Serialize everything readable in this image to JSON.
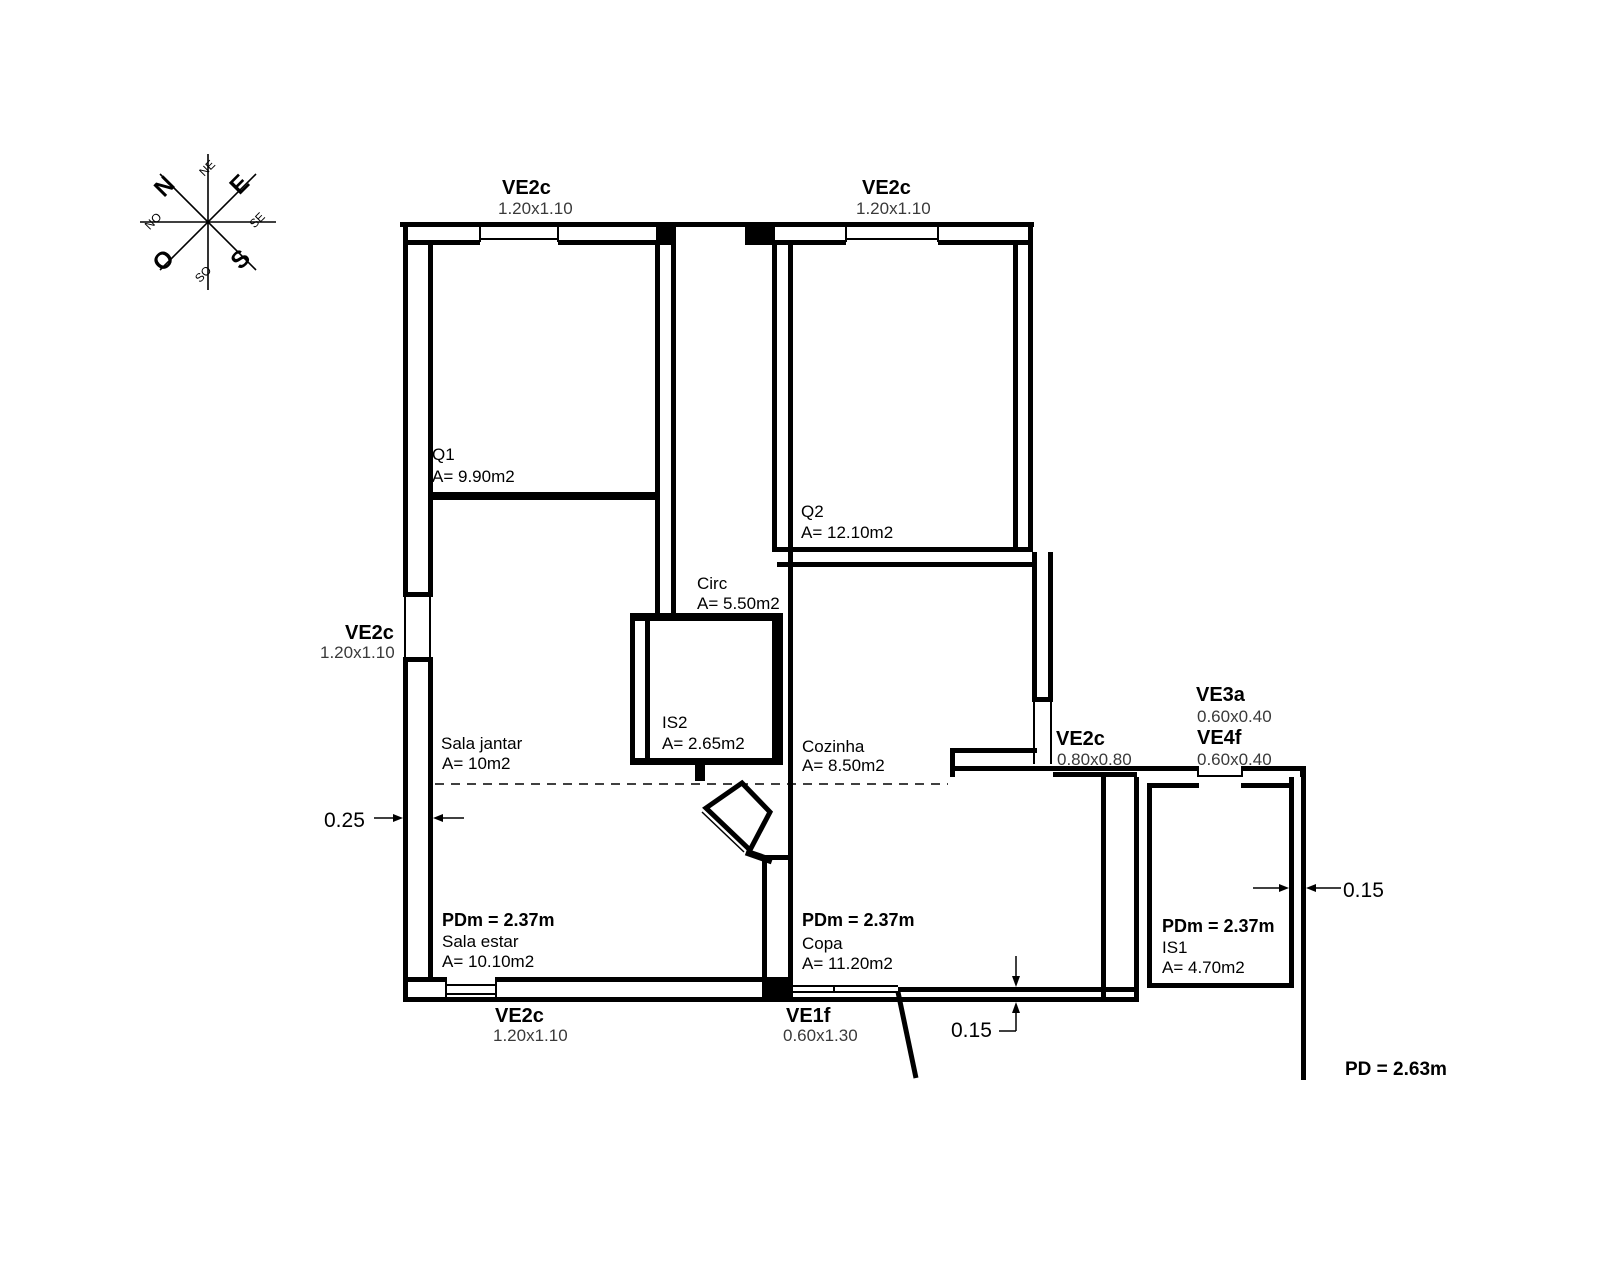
{
  "compass": {
    "n": "N",
    "e": "E",
    "s": "S",
    "o": "O",
    "ne": "NE",
    "se": "SE",
    "so": "SO",
    "no": "NO"
  },
  "openings": {
    "ve2c_top_left": {
      "code": "VE2c",
      "size": "1.20x1.10"
    },
    "ve2c_top_right": {
      "code": "VE2c",
      "size": "1.20x1.10"
    },
    "ve2c_left": {
      "code": "VE2c",
      "size": "1.20x1.10"
    },
    "ve2c_bottom": {
      "code": "VE2c",
      "size": "1.20x1.10"
    },
    "ve1f_bottom": {
      "code": "VE1f",
      "size": "0.60x1.30"
    },
    "ve2c_right": {
      "code": "VE2c",
      "size": "0.80x0.80"
    },
    "ve3a": {
      "code": "VE3a",
      "size": "0.60x0.40"
    },
    "ve4f": {
      "code": "VE4f",
      "size": "0.60x0.40"
    }
  },
  "rooms": {
    "q1": {
      "name": "Q1",
      "area": "A= 9.90m2"
    },
    "q2": {
      "name": "Q2",
      "area": "A= 12.10m2"
    },
    "circ": {
      "name": "Circ",
      "area": "A= 5.50m2"
    },
    "is2": {
      "name": "IS2",
      "area": "A= 2.65m2"
    },
    "cozinha": {
      "name": "Cozinha",
      "area": "A= 8.50m2"
    },
    "sala_jantar": {
      "name": "Sala jantar",
      "area": "A= 10m2"
    },
    "sala_estar": {
      "name": "Sala estar",
      "area": "A= 10.10m2",
      "pdm": "PDm = 2.37m"
    },
    "copa": {
      "name": "Copa",
      "area": "A= 11.20m2",
      "pdm": "PDm = 2.37m"
    },
    "is1": {
      "name": "IS1",
      "area": "A= 4.70m2",
      "pdm": "PDm = 2.37m"
    }
  },
  "dimensions": {
    "left_wall": "0.25",
    "bottom_wall": "0.15",
    "right_wall": "0.15"
  },
  "ceiling": {
    "pd": "PD = 2.63m"
  },
  "colors": {
    "dimension_red": "#c0334d",
    "wall": "#000000"
  }
}
